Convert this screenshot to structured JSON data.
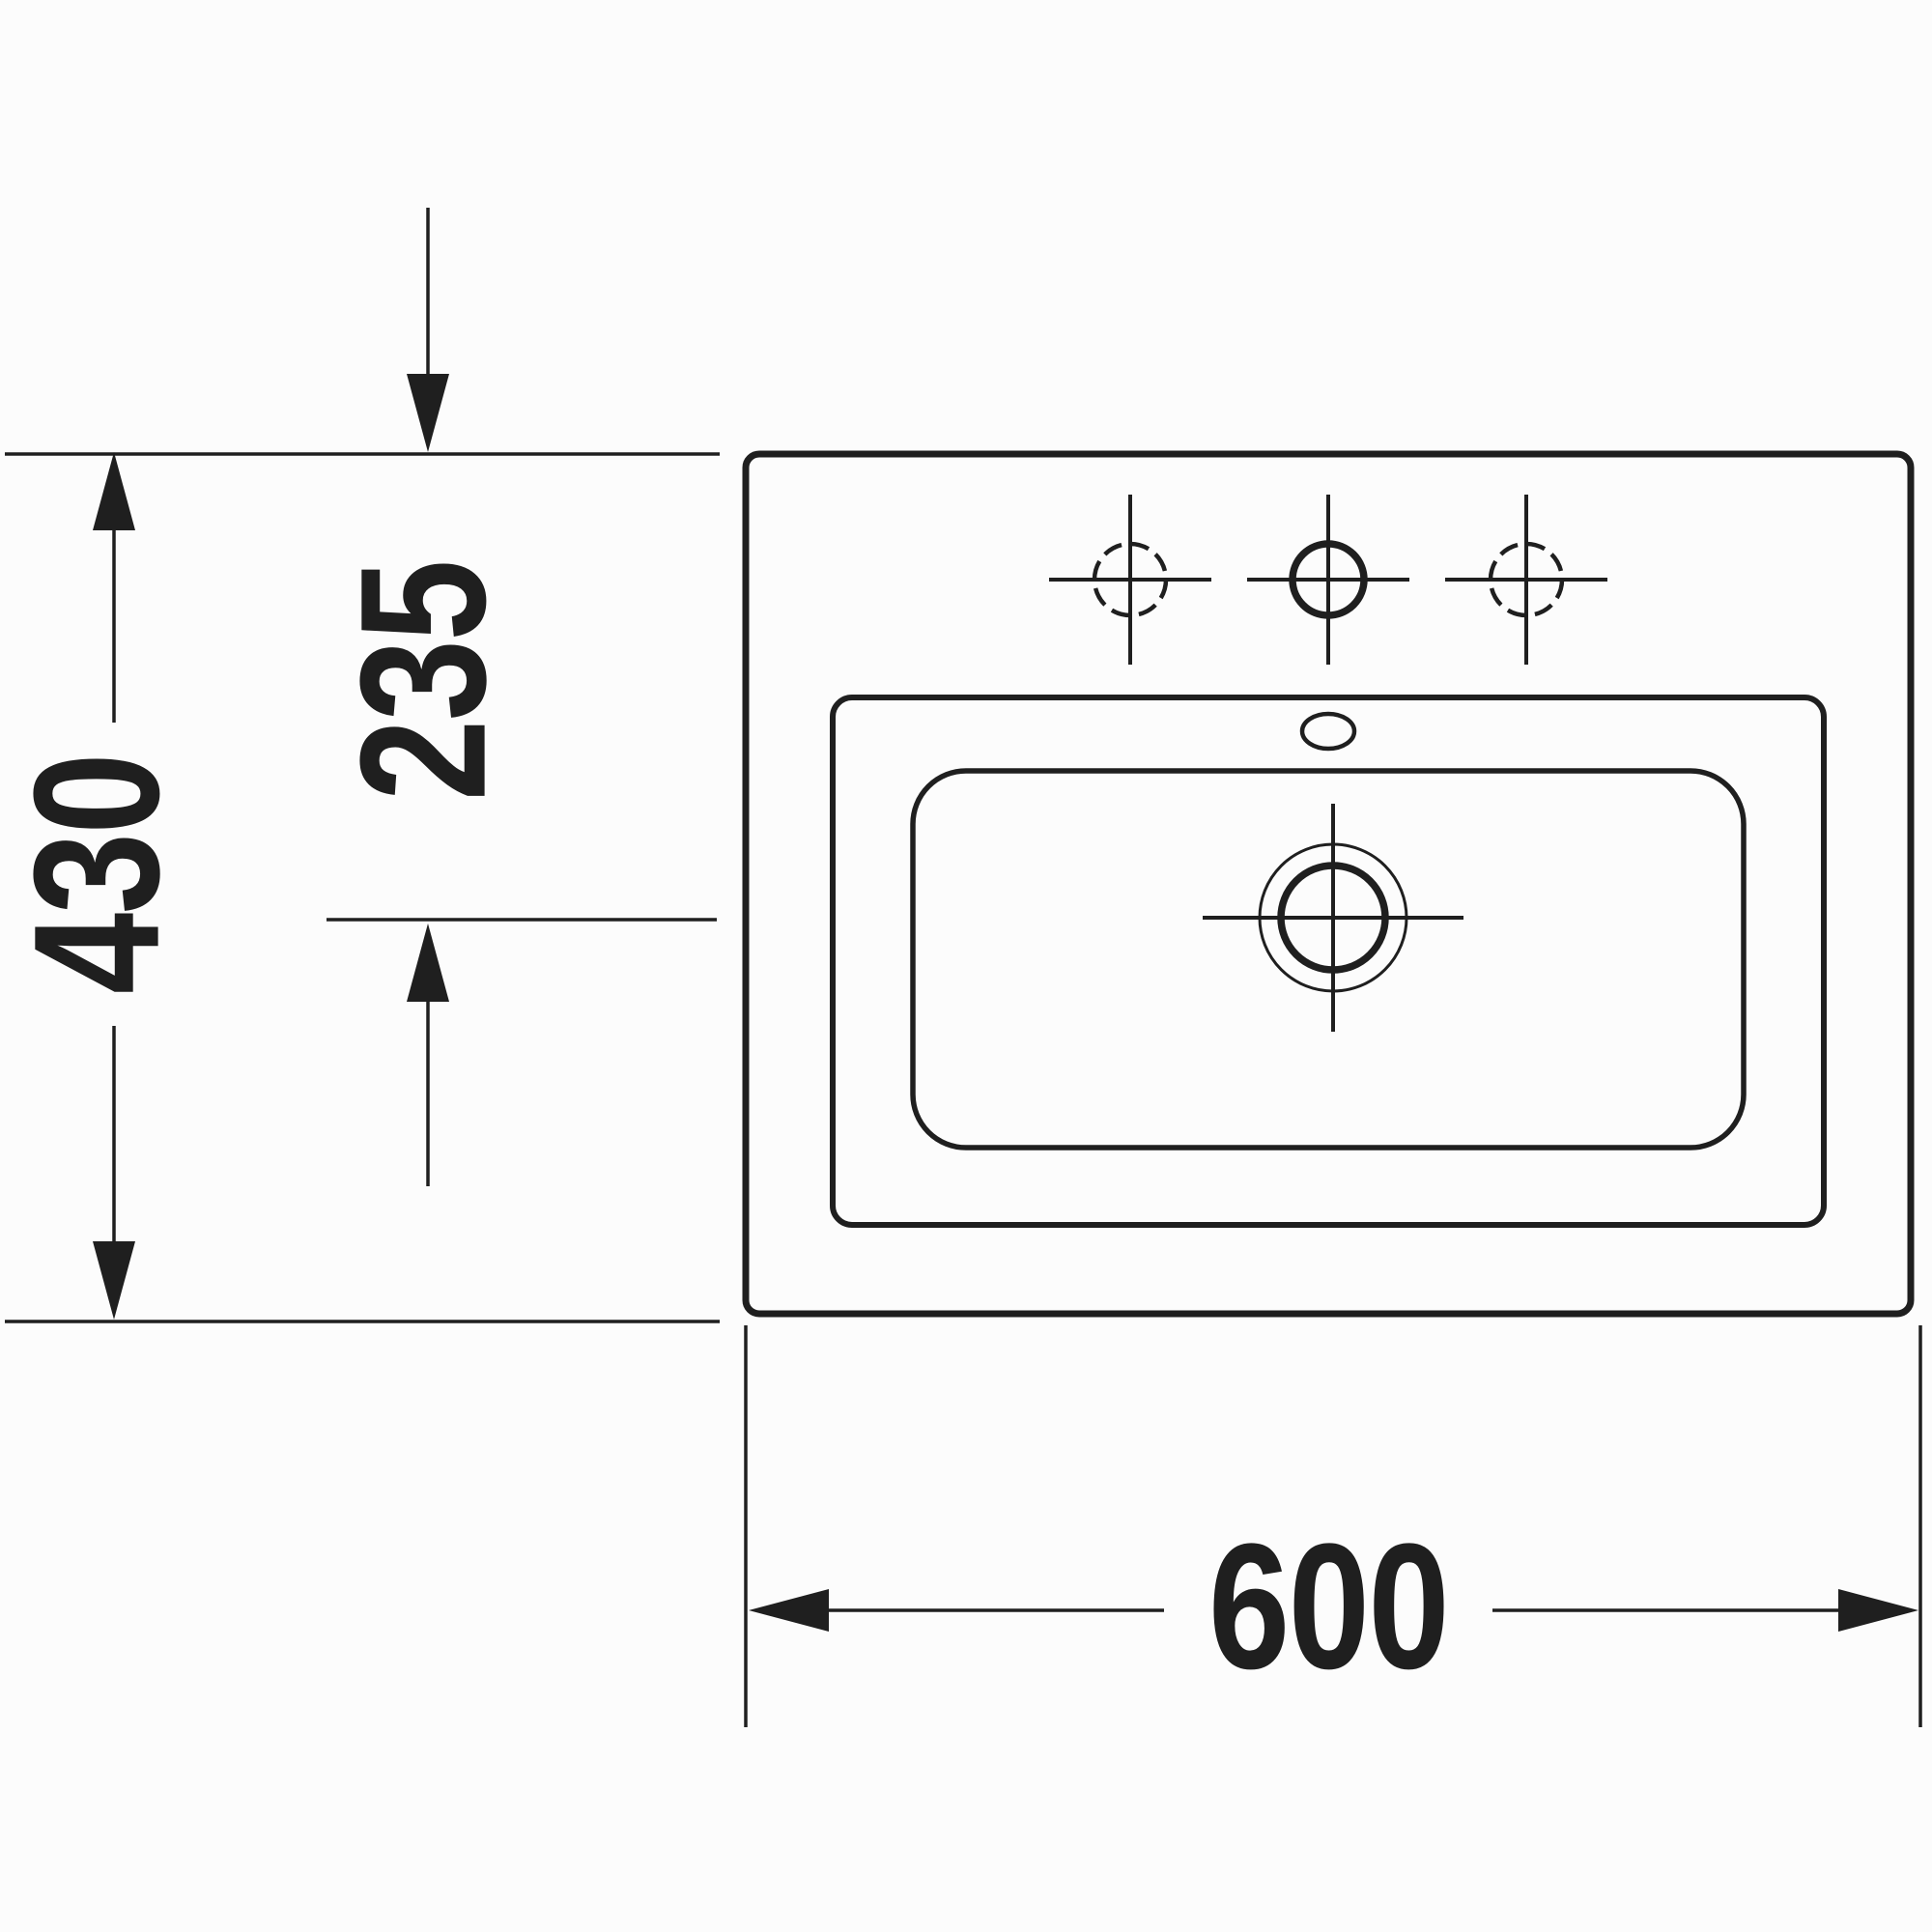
{
  "colors": {
    "line": "#1f1f1f",
    "background": "#fcfcfc"
  },
  "drawing": {
    "dimensions": {
      "depth_label": "430",
      "drain_offset_label": "235",
      "width_label": "600"
    }
  }
}
